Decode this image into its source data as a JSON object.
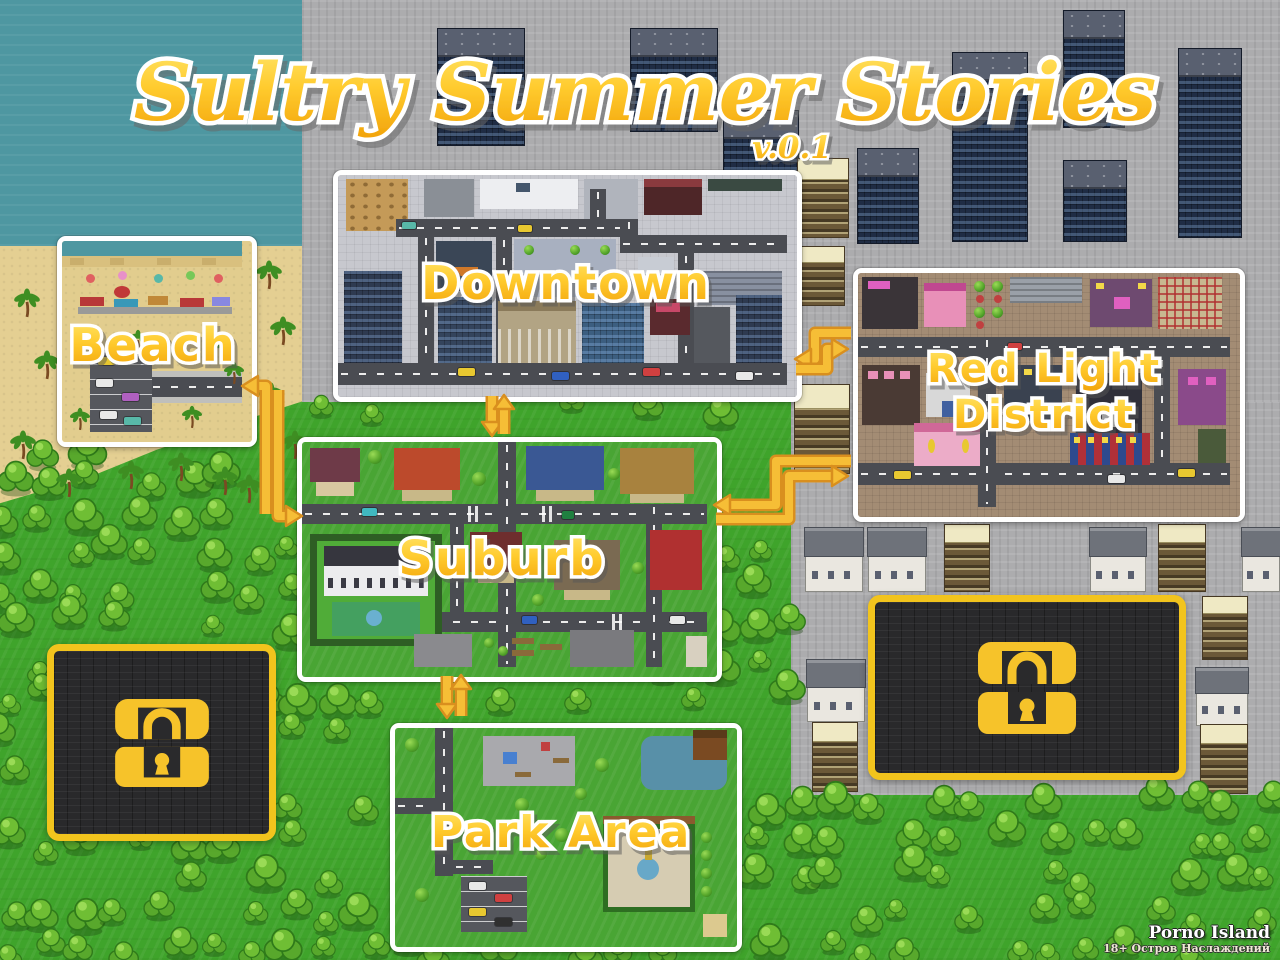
{
  "title": {
    "text": "Sultry Summer Stories",
    "version": "v.0.1"
  },
  "regions": {
    "beach": {
      "label": "Beach",
      "unlocked": true
    },
    "downtown": {
      "label": "Downtown",
      "unlocked": true
    },
    "red_light_district": {
      "label_line1": "Red Light",
      "label_line2": "District",
      "unlocked": true
    },
    "suburb": {
      "label": "Suburb",
      "unlocked": true
    },
    "park": {
      "label": "Park Area",
      "unlocked": true
    }
  },
  "locked_areas": {
    "count": 2,
    "icon": "lock-icon"
  },
  "connections": [
    {
      "from": "beach",
      "to": "suburb",
      "bidirectional": true
    },
    {
      "from": "downtown",
      "to": "suburb",
      "bidirectional": true
    },
    {
      "from": "downtown",
      "to": "red_light_district",
      "bidirectional": true
    },
    {
      "from": "suburb",
      "to": "red_light_district",
      "bidirectional": true
    },
    {
      "from": "suburb",
      "to": "park",
      "bidirectional": true
    }
  ],
  "watermark": {
    "line1": "Porno Island",
    "line2": "18+ Остров Наслаждений"
  },
  "colors": {
    "label_gold_light": "#FFE56A",
    "label_gold": "#FFCB2E",
    "label_gold_dark": "#F2A30A",
    "arrow": "#F6BE36",
    "arrow_edge": "#D98F1E",
    "locked_border": "#F2C41D",
    "locked_bg": "#29292B",
    "water": "#4E97A1",
    "sand": "#E4CF92",
    "grass": "#3FA42B",
    "pavement": "#ACACAE",
    "panel_border": "#FFFFFF"
  }
}
